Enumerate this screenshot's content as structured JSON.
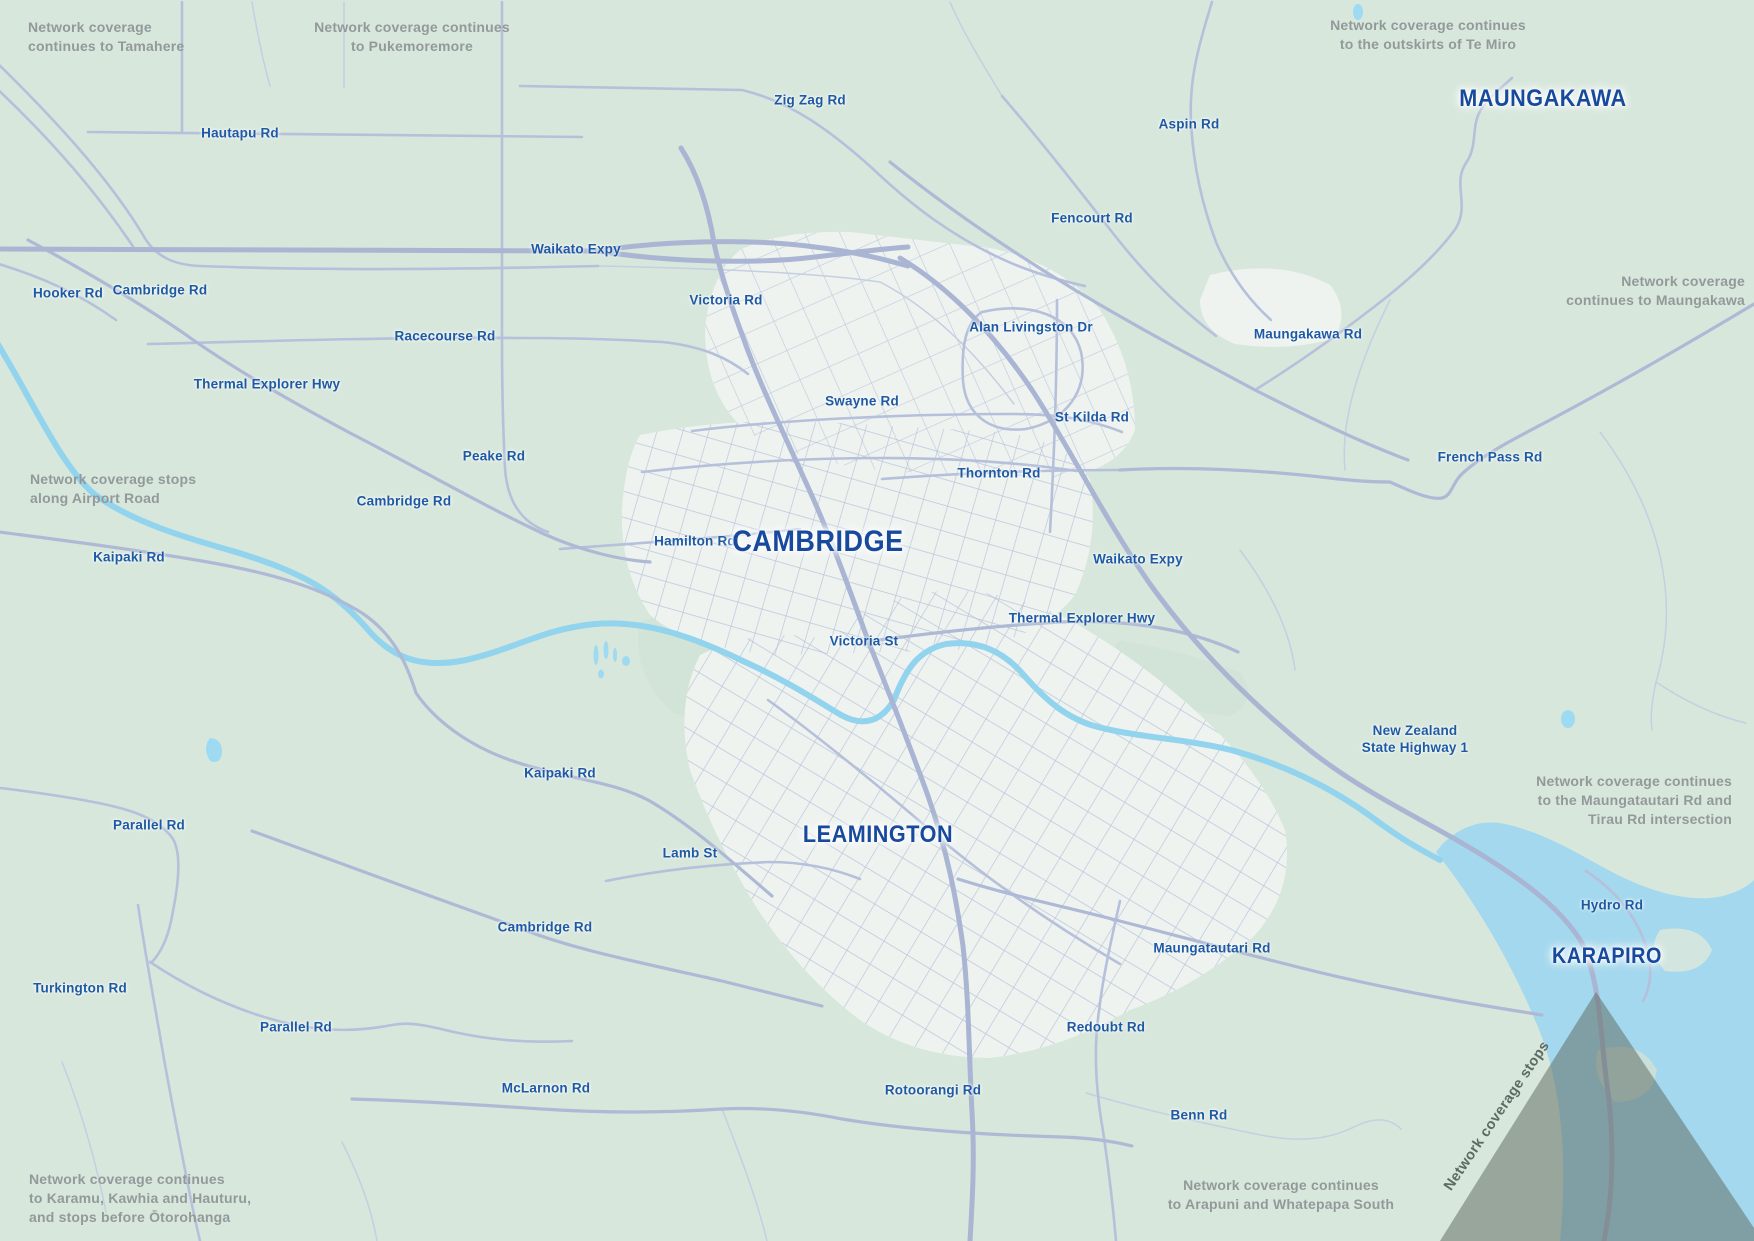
{
  "colors": {
    "background": "#d7e7dc",
    "park_green": "#cfe2d4",
    "urban_area": "#eef3f0",
    "road_major": "#a9b5d2",
    "road_minor": "#b6c0da",
    "road_lane": "#c6cee1",
    "river": "#92d3ed",
    "lake": "#a3d8ee",
    "pond": "#9edaf2",
    "road_label_blue": "#1e5aa4",
    "place_label_navy": "#17499c",
    "note_gray": "#93999b",
    "coverage_gap_gray": "#5f6c62"
  },
  "labels": {
    "places": [
      {
        "text": "MAUNGAKAWA",
        "x": 1543,
        "y": 99,
        "size": 24
      },
      {
        "text": "CAMBRIDGE",
        "x": 818,
        "y": 542,
        "size": 30
      },
      {
        "text": "LEAMINGTON",
        "x": 878,
        "y": 835,
        "size": 24
      },
      {
        "text": "KARAPIRO",
        "x": 1607,
        "y": 956,
        "size": 22
      }
    ],
    "roads": [
      {
        "text": "Hautapu Rd",
        "x": 240,
        "y": 134
      },
      {
        "text": "Zig Zag Rd",
        "x": 810,
        "y": 101
      },
      {
        "text": "Aspin Rd",
        "x": 1189,
        "y": 125
      },
      {
        "text": "Fencourt Rd",
        "x": 1092,
        "y": 219
      },
      {
        "text": "Waikato Expy",
        "x": 576,
        "y": 250
      },
      {
        "text": "Hooker Rd",
        "x": 68,
        "y": 294
      },
      {
        "text": "Cambridge Rd",
        "x": 160,
        "y": 291
      },
      {
        "text": "Victoria Rd",
        "x": 726,
        "y": 301
      },
      {
        "text": "Alan Livingston Dr",
        "x": 1031,
        "y": 328
      },
      {
        "text": "Maungakawa Rd",
        "x": 1308,
        "y": 335
      },
      {
        "text": "Racecourse Rd",
        "x": 445,
        "y": 337
      },
      {
        "text": "Thermal Explorer Hwy",
        "x": 267,
        "y": 385
      },
      {
        "text": "Swayne Rd",
        "x": 862,
        "y": 402
      },
      {
        "text": "St Kilda Rd",
        "x": 1092,
        "y": 418
      },
      {
        "text": "Peake Rd",
        "x": 494,
        "y": 457
      },
      {
        "text": "French Pass Rd",
        "x": 1490,
        "y": 458
      },
      {
        "text": "Thornton Rd",
        "x": 999,
        "y": 474
      },
      {
        "text": "Cambridge Rd",
        "x": 404,
        "y": 502
      },
      {
        "text": "Hamilton Rd",
        "x": 695,
        "y": 542
      },
      {
        "text": "Kaipaki Rd",
        "x": 129,
        "y": 558
      },
      {
        "text": "Waikato Expy",
        "x": 1138,
        "y": 560
      },
      {
        "text": "Thermal Explorer Hwy",
        "x": 1082,
        "y": 619
      },
      {
        "text": "Victoria St",
        "x": 864,
        "y": 642
      },
      {
        "text": "New Zealand\nState Highway 1",
        "x": 1415,
        "y": 740
      },
      {
        "text": "Kaipaki Rd",
        "x": 560,
        "y": 774
      },
      {
        "text": "Parallel Rd",
        "x": 149,
        "y": 826
      },
      {
        "text": "Lamb St",
        "x": 690,
        "y": 854
      },
      {
        "text": "Cambridge Rd",
        "x": 545,
        "y": 928
      },
      {
        "text": "Hydro Rd",
        "x": 1612,
        "y": 906
      },
      {
        "text": "Maungatautari Rd",
        "x": 1212,
        "y": 949
      },
      {
        "text": "Turkington Rd",
        "x": 80,
        "y": 989
      },
      {
        "text": "Parallel Rd",
        "x": 296,
        "y": 1028
      },
      {
        "text": "Redoubt Rd",
        "x": 1106,
        "y": 1028
      },
      {
        "text": "Rotoorangi Rd",
        "x": 933,
        "y": 1091
      },
      {
        "text": "Benn Rd",
        "x": 1199,
        "y": 1116
      },
      {
        "text": "McLarnon Rd",
        "x": 546,
        "y": 1089
      }
    ],
    "notes": [
      {
        "text": "Network coverage\ncontinues to Tamahere",
        "x": 28,
        "y": 18,
        "anchor": "left"
      },
      {
        "text": "Network coverage continues\nto Pukemoremore",
        "x": 412,
        "y": 18,
        "anchor": "center"
      },
      {
        "text": "Network coverage continues\nto the outskirts of Te Miro",
        "x": 1428,
        "y": 16,
        "anchor": "center"
      },
      {
        "text": "Network coverage\ncontinues to Maungakawa",
        "x": 1745,
        "y": 272,
        "anchor": "right"
      },
      {
        "text": "Network coverage stops\nalong Airport Road",
        "x": 30,
        "y": 470,
        "anchor": "left"
      },
      {
        "text": "Network coverage continues\nto the Maungatautari Rd and\nTirau Rd intersection",
        "x": 1732,
        "y": 772,
        "anchor": "right"
      },
      {
        "text": "Network coverage continues\nto Karamu, Kawhia and Hauturu,\nand stops before Ōtorohanga",
        "x": 29,
        "y": 1170,
        "anchor": "left"
      },
      {
        "text": "Network coverage continues\nto Arapuni and Whatepapa South",
        "x": 1281,
        "y": 1176,
        "anchor": "center"
      }
    ],
    "overlay_note": {
      "text": "Network coverage stops",
      "x": 1497,
      "y": 1116,
      "rotation": -56
    }
  }
}
